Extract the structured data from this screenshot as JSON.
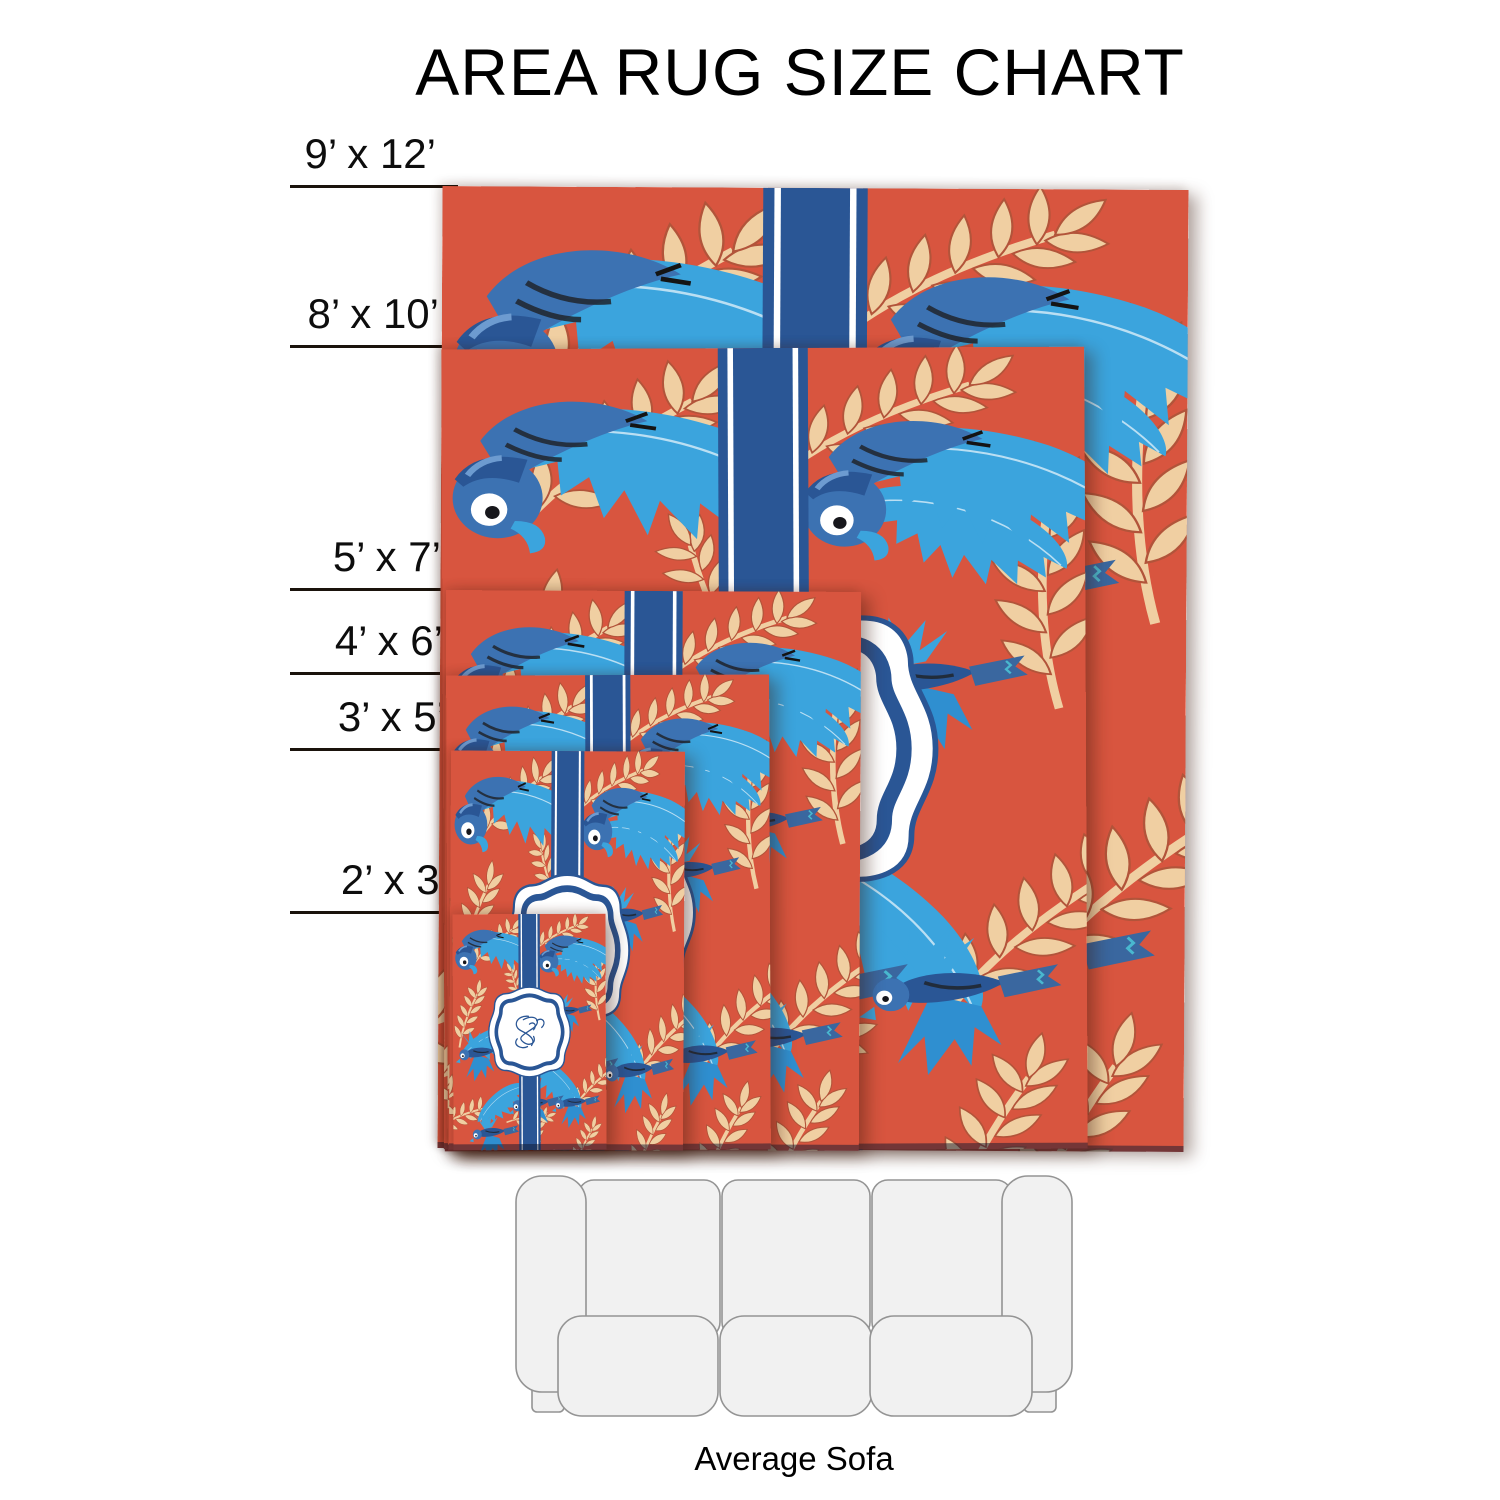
{
  "title": "AREA RUG SIZE CHART",
  "rugs": [
    {
      "id": "9x12",
      "label": "9’ x 12’"
    },
    {
      "id": "8x10",
      "label": "8’ x 10’"
    },
    {
      "id": "5x7",
      "label": "5’ x 7’"
    },
    {
      "id": "4x6",
      "label": "4’ x 6’"
    },
    {
      "id": "3x5",
      "label": "3’ x 5’"
    },
    {
      "id": "2x3",
      "label": "2’ x 3’"
    }
  ],
  "sofa": {
    "label": "Average Sofa"
  },
  "colors": {
    "rug_red": "#d8553f",
    "leaf_blue": "#3ba4dd",
    "leaf_blue_deep": "#2f8fd0",
    "bird_blue": "#3c72b2",
    "ribbon_navy": "#2a5695",
    "leaf_cream": "#f0cfa2",
    "outline_rust": "#b2543a",
    "detail_dark": "#20242b",
    "label_line": "#1a130c",
    "sofa_fill": "#f1f1f1",
    "sofa_stroke": "#949494"
  }
}
